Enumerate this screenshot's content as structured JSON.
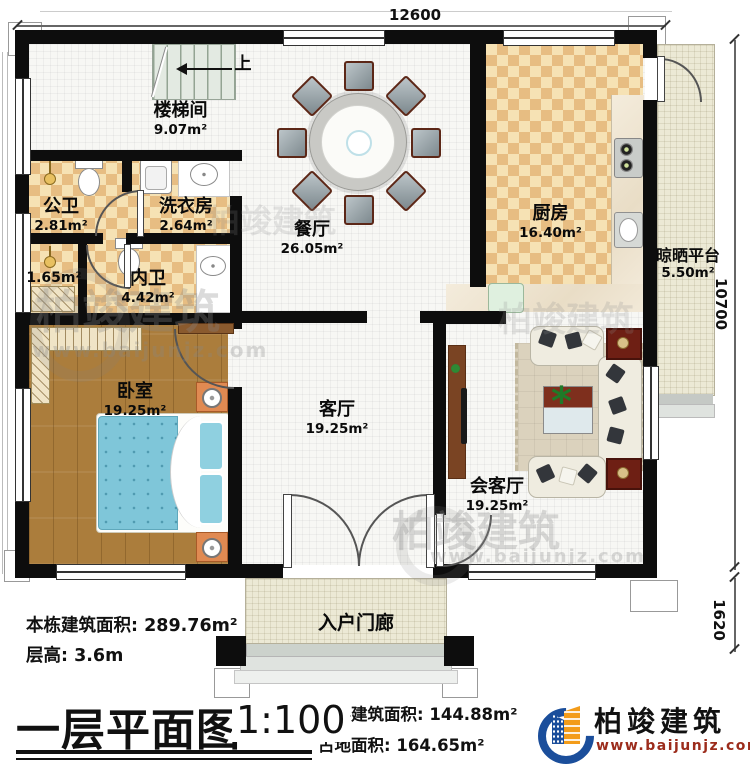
{
  "plan": {
    "dimensions": {
      "width_top": "12600",
      "height_right": "10700",
      "porch_right": "1620"
    },
    "stairs_up_label": "上",
    "rooms": {
      "stairwell": {
        "name": "楼梯间",
        "area": "9.07m²"
      },
      "public_bath": {
        "name": "公卫",
        "area": "2.81m²"
      },
      "laundry": {
        "name": "洗衣房",
        "area": "2.64m²"
      },
      "inner_bath": {
        "name": "内卫",
        "area": "4.42m²"
      },
      "closet": {
        "area": "1.65m²"
      },
      "dining": {
        "name": "餐厅",
        "area": "26.05m²"
      },
      "kitchen": {
        "name": "厨房",
        "area": "16.40m²"
      },
      "drying_platform": {
        "name": "晾晒平台",
        "area": "5.50m²"
      },
      "bedroom": {
        "name": "卧室",
        "area": "19.25m²"
      },
      "living": {
        "name": "客厅",
        "area": "19.25m²"
      },
      "reception": {
        "name": "会客厅",
        "area": "19.25m²"
      },
      "porch": {
        "name": "入户门廊"
      }
    }
  },
  "info_block": {
    "building_total_label": "本栋建筑面积:",
    "building_total_value": "289.76m²",
    "floor_height_label": "层高:",
    "floor_height_value": "3.6m"
  },
  "title_bar": {
    "title": "一层平面图",
    "scale": "1:100",
    "floor_area_label": "本层建筑面积:",
    "floor_area_value": "144.88m²",
    "land_area_label": "占地面积:",
    "land_area_value": "164.65m²"
  },
  "logo": {
    "company": "柏竣建筑",
    "website": "www.baijunjz.com"
  },
  "watermark": {
    "company": "柏竣建筑",
    "website": "www.baijunjz.com"
  },
  "colors": {
    "wall": "#0d0d0d",
    "checker_light": "#f6e2b4",
    "checker_dark": "#e7bd82",
    "wood_floor": "#ab7d3c",
    "bed_blue": "#7fc6d9",
    "logo_blue": "#1b4e9b",
    "logo_orange": "#f39c1a",
    "website_red": "#9c2c1c"
  }
}
